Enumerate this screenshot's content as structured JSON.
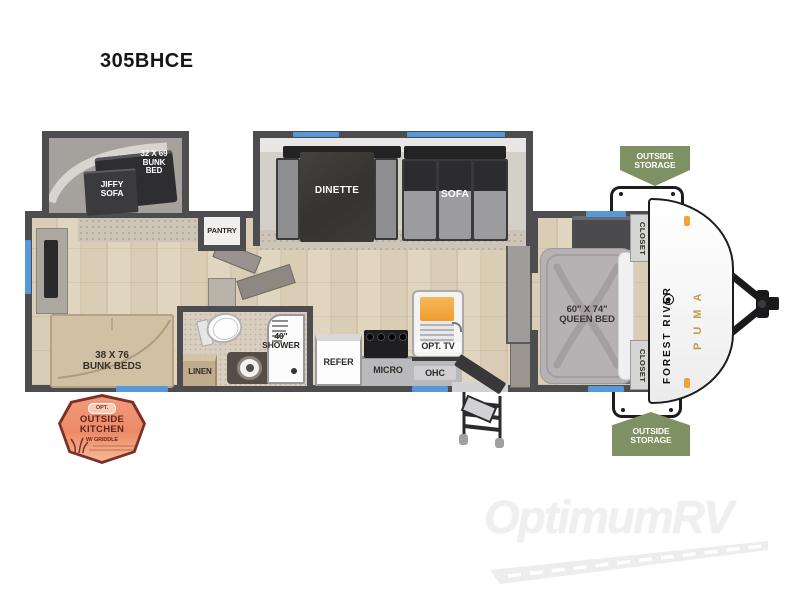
{
  "title": "305BHCE",
  "floorplan": {
    "rooms": {
      "bunk_slide_bed": "32 X 69\nBUNK\nBED",
      "jiffy_sofa": "JIFFY\nSOFA",
      "dinette": "DINETTE",
      "sofa": "SOFA",
      "pantry": "PANTRY",
      "rear_bunks": "38 X 76\nBUNK BEDS",
      "linen": "LINEN",
      "shower": "40\"\nSHOWER",
      "refer": "REFER",
      "micro": "MICRO",
      "ohc": "OHC",
      "opt_tv": "OPT. TV",
      "queen_bed": "60\" X 74\"\nQUEEN BED",
      "closet_front_top": "CLOSET",
      "closet_front_bottom": "CLOSET"
    },
    "badges": {
      "outside_storage_front_top": "OUTSIDE\nSTORAGE",
      "outside_storage_front_bottom": "OUTSIDE\nSTORAGE",
      "outside_kitchen": {
        "opt": "OPT.",
        "line1": "OUTSIDE",
        "line2": "KITCHEN",
        "line3": "W/ GRIDDLE"
      }
    },
    "branding": {
      "manufacturer": "FOREST RIVER",
      "series": "PUMA"
    },
    "colors": {
      "wall": "#4d4d4f",
      "window": "#5599db",
      "badge_green": "#7d9163",
      "badge_orange": "#ec8f6e",
      "badge_orange_border": "#7c3027",
      "puma_gold": "#c59b4a",
      "marker_light": "#f0a33c"
    }
  },
  "watermark": {
    "text": "OptimumRV"
  }
}
